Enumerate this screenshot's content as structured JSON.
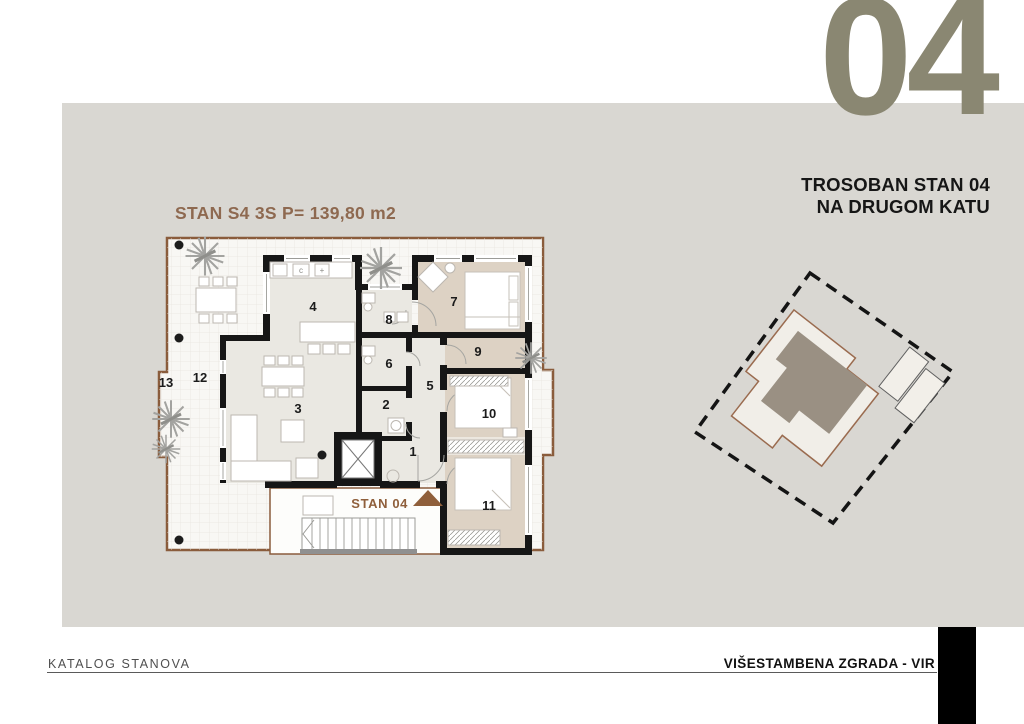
{
  "header": {
    "unit_number": "04",
    "subtitle_line1": "TROSOBAN STAN 04",
    "subtitle_line2": "NA DRUGOM KATU"
  },
  "plan": {
    "title": "STAN S4 3S P= 139,80 m2",
    "apartment_label": "STAN 04",
    "room_labels": [
      "1",
      "2",
      "3",
      "4",
      "5",
      "6",
      "7",
      "8",
      "9",
      "10",
      "11",
      "12",
      "13"
    ],
    "kitchen_marks": {
      "cooktop": "c",
      "sink": "+"
    }
  },
  "footer": {
    "left": "KATALOG STANOVA",
    "right": "VIŠESTAMBENA ZGRADA - VIR"
  },
  "colors": {
    "band_gray": "#D9D7D2",
    "accent_number": "#8A8772",
    "plan_title_brown": "#8E6950",
    "terrace_border_brown": "#8A5C3C",
    "room_tan": "#DDD2C4",
    "room_light": "#EAE8E2",
    "wall_black": "#161616",
    "site_highlight_taupe": "#9A9083"
  }
}
